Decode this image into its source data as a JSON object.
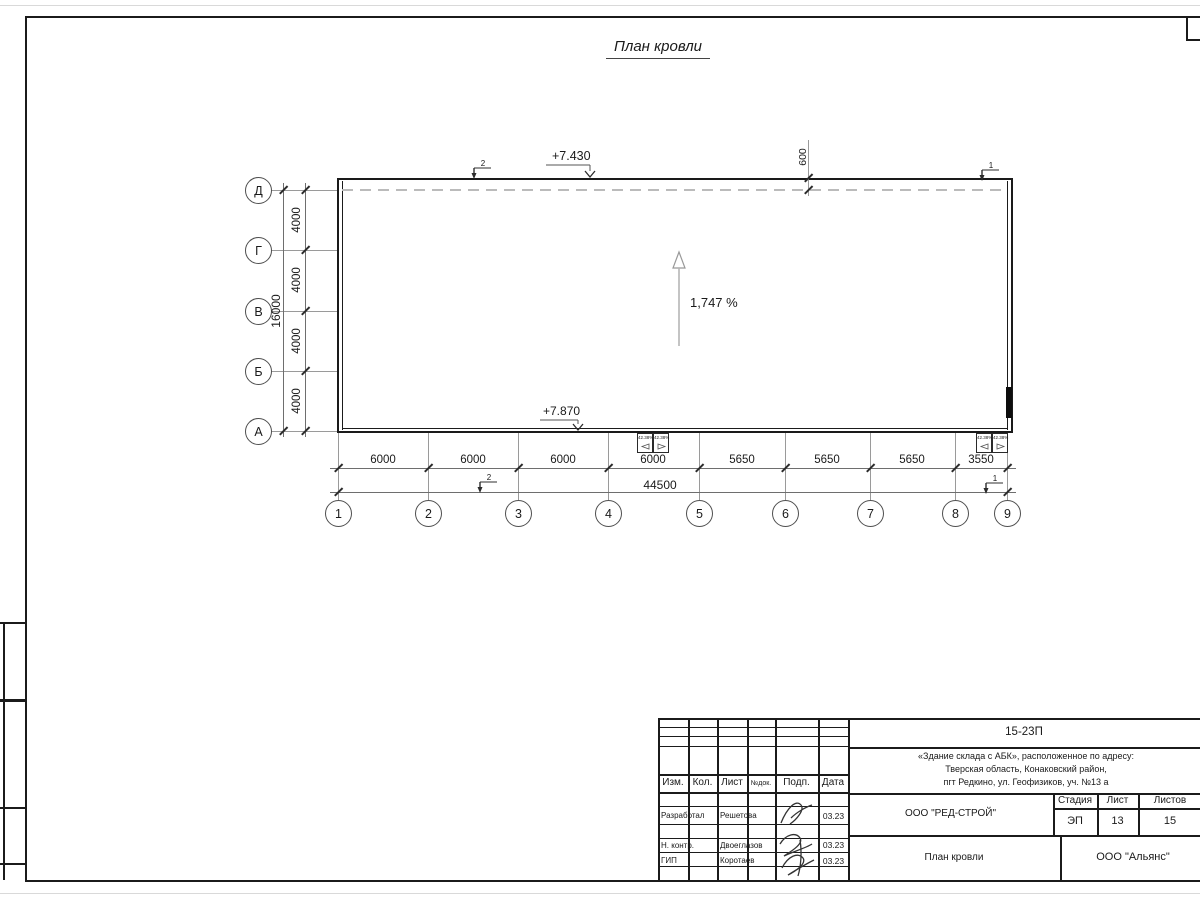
{
  "colors": {
    "line": "#1a1a1a",
    "axis": "#9a9a9a"
  },
  "page": {
    "title": "План кровли"
  },
  "drawing": {
    "slope_label": "1,747 %",
    "elevation_top": "+7.430",
    "elevation_bottom": "+7.870",
    "overhang_dim": "600",
    "section_left": "2",
    "section_right": "1",
    "row_axes": [
      "Д",
      "Г",
      "В",
      "Б",
      "А"
    ],
    "row_dims": [
      "4000",
      "4000",
      "4000",
      "4000"
    ],
    "row_total": "16000",
    "col_axes": [
      "1",
      "2",
      "3",
      "4",
      "5",
      "6",
      "7",
      "8",
      "9"
    ],
    "col_dims": [
      "6000",
      "6000",
      "6000",
      "6000",
      "5650",
      "5650",
      "5650",
      "3550"
    ],
    "col_total": "44500",
    "drain_label": "42.38%"
  },
  "title_block": {
    "doc_number": "15-23П",
    "project_address": [
      "«Здание склада с АБК», расположенное по адресу:",
      "Тверская область, Конаковский район,",
      "пгт Редкино, ул. Геофизиков, уч. №13 а"
    ],
    "columns": {
      "izm": "Изм.",
      "kol": "Кол.",
      "list": "Лист",
      "ndok": "№док.",
      "podp": "Подп.",
      "data": "Дата"
    },
    "signers": [
      {
        "role": "Разработал",
        "name": "Решетова",
        "date": "03.23"
      },
      {
        "role": "Н. контр.",
        "name": "Двоеглазов",
        "date": "03.23"
      },
      {
        "role": "ГИП",
        "name": "Коротаев",
        "date": "03.23"
      }
    ],
    "company": "ООО \"РЕД-СТРОЙ\"",
    "stage_label": "Стадия",
    "stage_value": "ЭП",
    "sheet_label": "Лист",
    "sheet_value": "13",
    "sheets_label": "Листов",
    "sheets_value": "15",
    "sheet_title": "План кровли",
    "org": "ООО \"Альянс\""
  }
}
